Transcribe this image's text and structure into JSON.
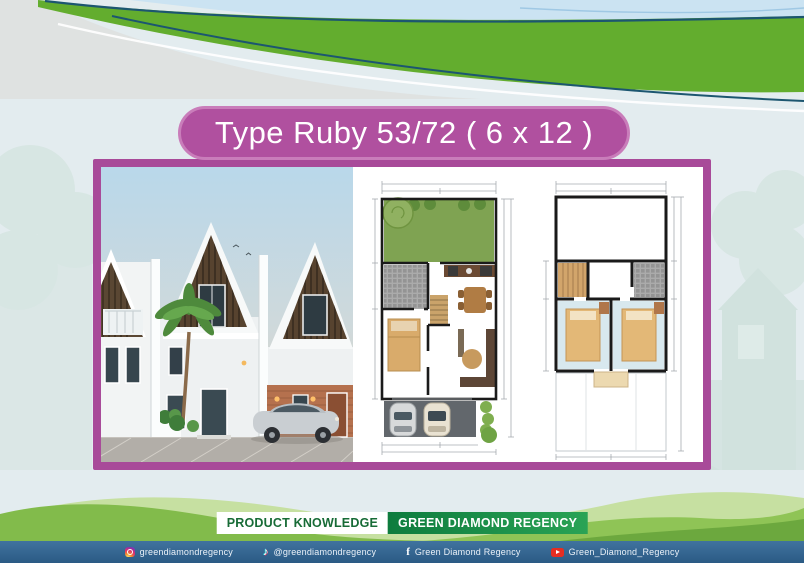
{
  "title": "Type Ruby 53/72 ( 6 x 12 )",
  "badges": {
    "product_knowledge": "PRODUCT KNOWLEDGE",
    "brand": "GREEN DIAMOND REGENCY"
  },
  "gallery": {
    "house_render": "two-storey-house-exterior-3d-render",
    "floorplan_ground": "ground-floor-plan-with-garden-and-carport",
    "floorplan_upper": "upper-floor-plan-with-two-bedrooms"
  },
  "footer": {
    "social": [
      {
        "icon": "instagram-icon",
        "glyph": "",
        "handle": "greendiamondregency"
      },
      {
        "icon": "tiktok-icon",
        "glyph": "♪",
        "handle": "@greendiamondregency"
      },
      {
        "icon": "facebook-icon",
        "glyph": "f",
        "handle": "Green Diamond Regency"
      },
      {
        "icon": "youtube-icon",
        "glyph": "",
        "handle": "Green_Diamond_Regency"
      }
    ]
  },
  "colors": {
    "frame_magenta": "#a84a99",
    "pill_magenta": "#b0509f",
    "wave_green": "#63ad2e",
    "line_teal": "#1c5670",
    "badge_green_dark": "#0e7c3e",
    "badge_green_light": "#2aa355",
    "badge_text_green": "#176b36",
    "footer_blue": "#356a95",
    "background": "#e3ecef"
  }
}
